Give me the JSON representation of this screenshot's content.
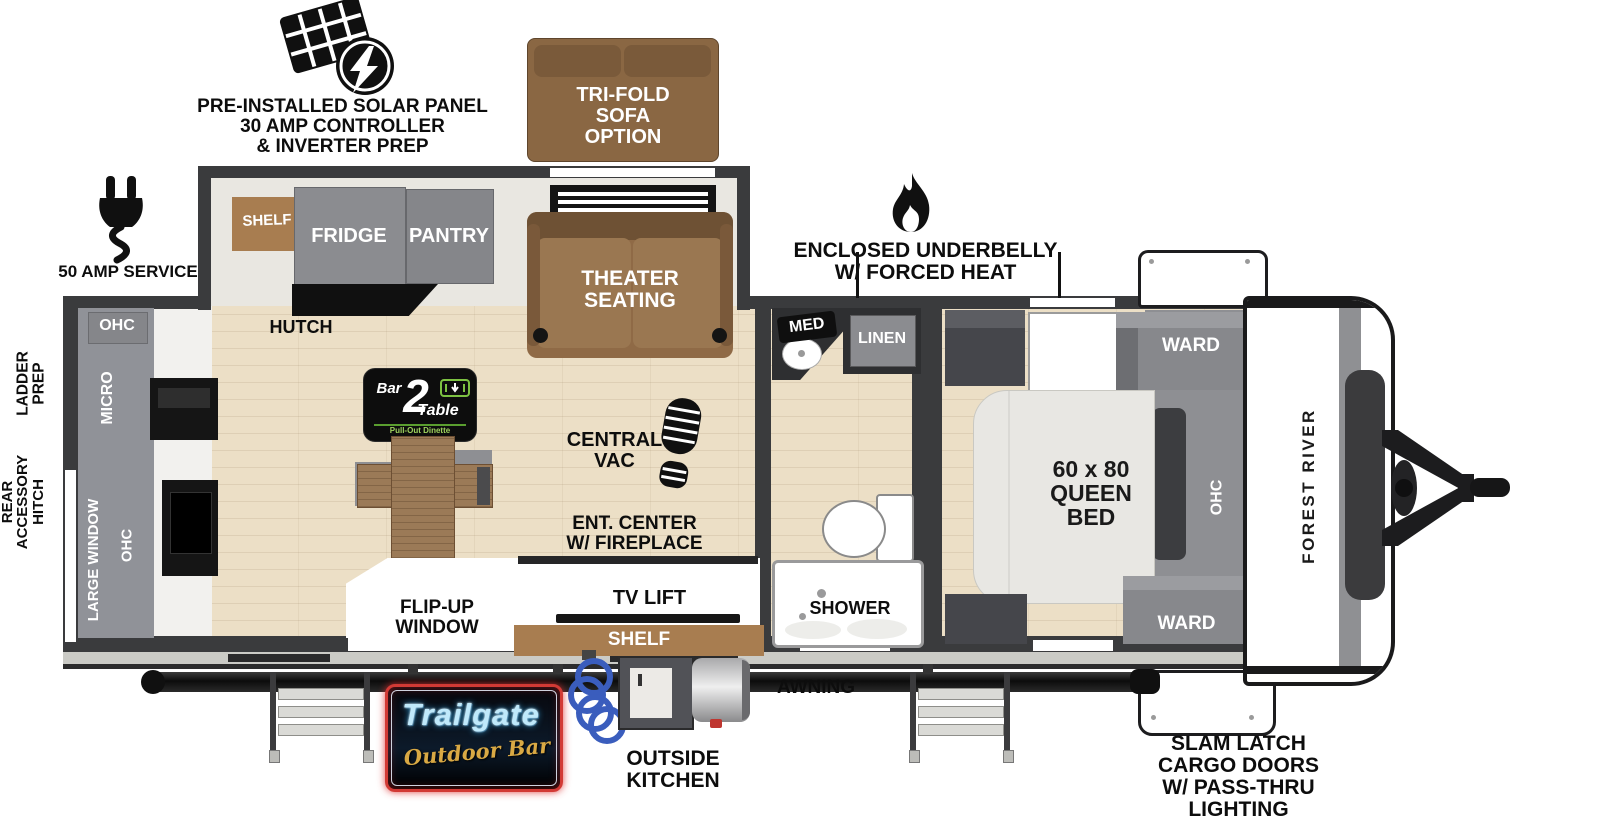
{
  "colors": {
    "wall": "#3a3b3d",
    "wood_floor": "#ecdfc6",
    "cabinet_gray": "#8e8f93",
    "sofa_brown": "#8f6a46",
    "shelf_brown": "#a87d50",
    "bed_white": "#e8e7e3",
    "neon_blue": "#9adcf5",
    "neon_gold": "#d9a944",
    "neon_red": "#d23a35",
    "logo_green": "#7dc242",
    "hose_blue": "#3a5dbd"
  },
  "annotations": {
    "solar": {
      "line1": "PRE-INSTALLED SOLAR PANEL",
      "line2": "30 AMP CONTROLLER",
      "line3": "& INVERTER PREP"
    },
    "trifold": {
      "line1": "TRI-FOLD",
      "line2": "SOFA",
      "line3": "OPTION"
    },
    "amp_service": "50 AMP SERVICE",
    "underbelly": {
      "line1": "ENCLOSED UNDERBELLY",
      "line2": "W/ FORCED HEAT"
    },
    "rear_hitch": {
      "line1": "REAR",
      "line2": "ACCESSORY",
      "line3": "HITCH"
    },
    "ladder_prep": {
      "line1": "LADDER",
      "line2": "PREP"
    },
    "awning": "AWNING",
    "outside_kitchen": {
      "line1": "OUTSIDE",
      "line2": "KITCHEN"
    },
    "slam_latch": {
      "line1": "SLAM LATCH",
      "line2": "CARGO DOORS",
      "line3": "W/ PASS-THRU",
      "line4": "LIGHTING"
    }
  },
  "kitchen": {
    "shelf": "SHELF",
    "fridge": "FRIDGE",
    "pantry": "PANTRY",
    "hutch": "HUTCH",
    "ohc_upper": "OHC",
    "micro": "MICRO",
    "large_window": "LARGE WINDOW",
    "ohc_lower": "OHC"
  },
  "living": {
    "theater": {
      "line1": "THEATER",
      "line2": "SEATING"
    },
    "central_vac": {
      "line1": "CENTRAL",
      "line2": "VAC"
    },
    "ent_center": {
      "line1": "ENT. CENTER",
      "line2": "W/ FIREPLACE"
    },
    "tv_lift": "TV LIFT",
    "shelf": "SHELF",
    "flip_window": {
      "line1": "FLIP-UP",
      "line2": "WINDOW"
    }
  },
  "bath": {
    "med": "MED",
    "linen": "LINEN",
    "shower": "SHOWER"
  },
  "bedroom": {
    "ward_top": "WARD",
    "ward_bottom": "WARD",
    "ohc": "OHC",
    "bed": {
      "line1": "60 x 80",
      "line2": "QUEEN",
      "line3": "BED"
    },
    "brand": "FOREST RIVER"
  },
  "logos": {
    "bar2table": {
      "bar": "Bar",
      "num": "2",
      "table": "Table",
      "sub": "Pull-Out Dinette"
    },
    "trailgate": {
      "name": "Trailgate",
      "sub": "Outdoor Bar"
    }
  }
}
